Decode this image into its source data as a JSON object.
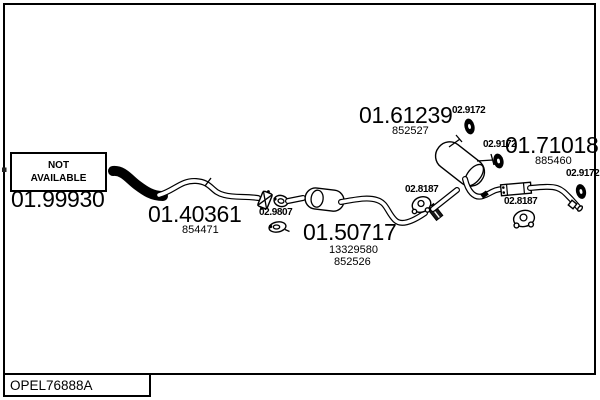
{
  "footer": {
    "code": "OPEL76888A"
  },
  "not_available": {
    "line1": "NOT",
    "line2": "AVAILABLE"
  },
  "parts": {
    "front_section": {
      "number": "01.99930"
    },
    "front_pipe": {
      "number": "01.40361",
      "ref": "854471"
    },
    "center_silencer": {
      "number": "01.50717",
      "ref1": "13329580",
      "ref2": "852526"
    },
    "rear_muffler": {
      "number": "01.61239",
      "ref": "852527"
    },
    "tail_pipe": {
      "number": "01.71018",
      "ref": "885460"
    }
  },
  "hardware": {
    "gasket": {
      "number": "02.9807"
    },
    "mount_top": {
      "number": "02.9172"
    },
    "mount_mid": {
      "number": "02.9172"
    },
    "mount_tail": {
      "number": "02.9172"
    },
    "hanger_mid": {
      "number": "02.8187"
    },
    "hanger_rear": {
      "number": "02.8187"
    }
  },
  "icons": {
    "rubber_mount": "filled black oval grommet with slot",
    "rubber_hanger": "round rubber hanger with center hole",
    "gasket_ring": "oval gasket ring with bolt dot"
  },
  "colors": {
    "line": "#000000",
    "background": "#ffffff"
  }
}
